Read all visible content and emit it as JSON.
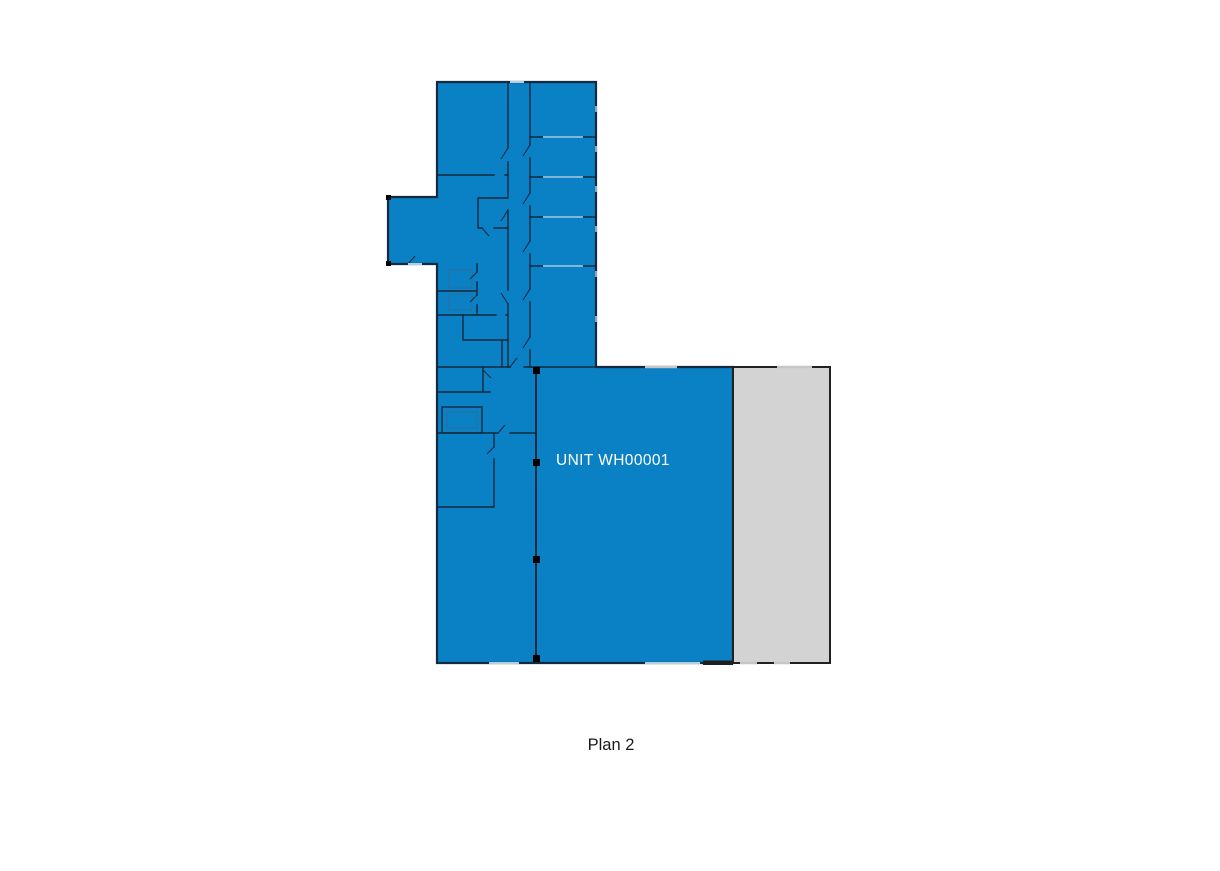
{
  "plan": {
    "unit_label": "UNIT WH00001",
    "caption": "Plan 2"
  },
  "colors": {
    "background": "#ffffff",
    "unit_fill": "#0a80c5",
    "adjacent_area_fill": "#d3d3d3",
    "wall": "#14293d",
    "exterior_outline": "#212121",
    "unit_label_text": "#ffffff",
    "caption_text": "#1a1a1a",
    "opening_blue": "#aecfe4",
    "opening_gray": "#c6c6c6",
    "column_marker": "#000000"
  }
}
